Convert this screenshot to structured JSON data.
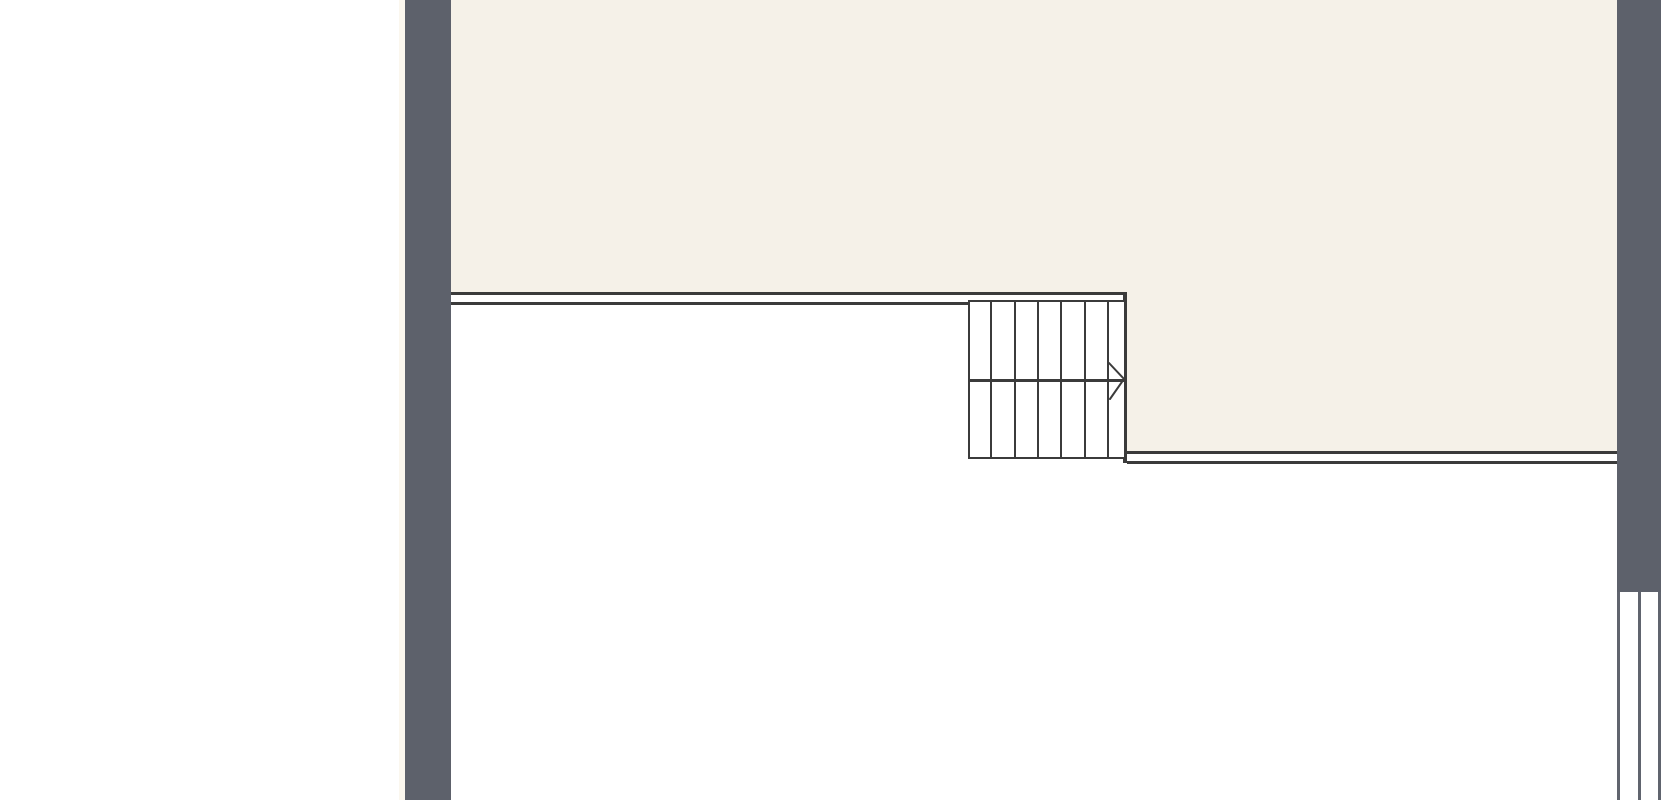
{
  "canvas": {
    "width": 1670,
    "height": 800
  },
  "colors": {
    "background": "#ffffff",
    "wall_fill": "#5d616b",
    "floor_fill": "#f5f1e8",
    "line": "#3b3b3b",
    "window_line": "#60646e",
    "outer_edge": "#fbf7ee"
  },
  "plan": {
    "stair": {
      "tread_columns": 7,
      "tread_line_offsets": [
        20,
        44,
        67,
        90,
        114,
        137
      ],
      "landing_offset": 77,
      "direction": "right",
      "arrow_points": "1109,363 1124,379 1110,399"
    },
    "window": {
      "left": 1617,
      "top": 592,
      "height": 208,
      "line_width": 3,
      "line_offsets": [
        0,
        20.5,
        41
      ]
    }
  }
}
